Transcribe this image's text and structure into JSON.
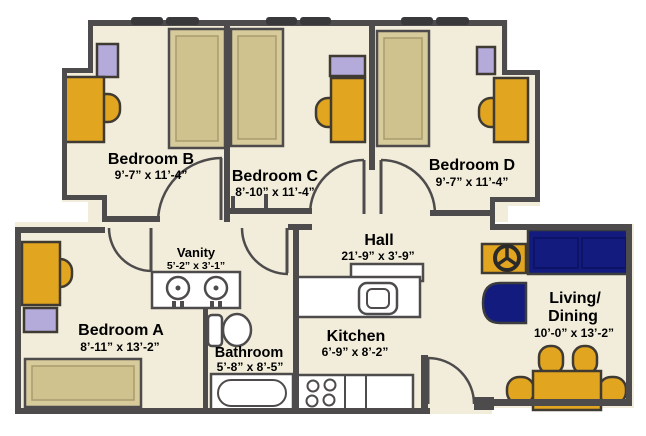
{
  "floor_plan": {
    "rooms": [
      {
        "name": "Bedroom B",
        "dimensions": "9’-7” x 11’-4”"
      },
      {
        "name": "Bedroom C",
        "dimensions": "8’-10” x 11’-4”"
      },
      {
        "name": "Bedroom D",
        "dimensions": "9’-7” x 11’-4”"
      },
      {
        "name": "Hall",
        "dimensions": "21’-9” x 3’-9”"
      },
      {
        "name": "Vanity",
        "dimensions": "5’-2” x 3’-1”"
      },
      {
        "name": "Bedroom A",
        "dimensions": "8’-11” x 13’-2”"
      },
      {
        "name": "Bathroom",
        "dimensions": "5’-8” x 8’-5”"
      },
      {
        "name": "Kitchen",
        "dimensions": "6’-9” x 8’-2”"
      },
      {
        "name_line1": "Living/",
        "name_line2": "Dining",
        "dimensions": "10’-0” x 13’-2”"
      }
    ],
    "colors": {
      "floor": "#f2edda",
      "wall": "#4e4b4c",
      "bed": "#d7cb9b",
      "wood": "#e2a51f",
      "dresser": "#b4abdb",
      "upholstery": "#131c7e",
      "fixture": "#ffffff"
    }
  }
}
